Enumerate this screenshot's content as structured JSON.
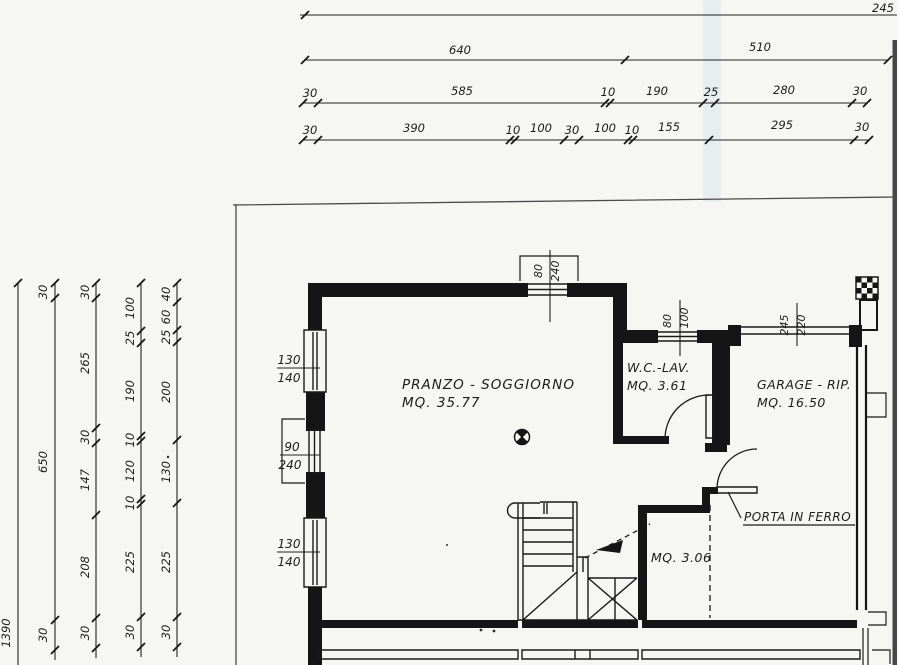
{
  "colors": {
    "ink": "#1c1c1c",
    "paper": "#f6f6f3",
    "scan_edge": "#474747",
    "artifact_band": "#d7e2ea"
  },
  "rooms": {
    "pranzo": {
      "name": "PRANZO - SOGGIORNO",
      "area": "MQ. 35.77"
    },
    "wc": {
      "name": "W.C.-LAV.",
      "area": "MQ. 3.61"
    },
    "garage": {
      "name": "GARAGE - RIP.",
      "area": "MQ. 16.50"
    },
    "hall": {
      "area": "MQ. 3.06"
    },
    "door_note": "PORTA IN FERRO"
  },
  "openings": {
    "win1": {
      "w": "130",
      "h": "140"
    },
    "door_left": {
      "w": "90",
      "h": "240"
    },
    "win2": {
      "w": "130",
      "h": "140"
    },
    "entrance": {
      "w": "80",
      "h": "240"
    },
    "wc_window": {
      "w": "80",
      "h": "100"
    },
    "garage_door": {
      "w": "245",
      "h": "220"
    }
  },
  "dims": {
    "top": {
      "row1": [
        "245"
      ],
      "row2": [
        "640",
        "510"
      ],
      "row3": [
        "30",
        "585",
        "10",
        "190",
        "25",
        "280",
        "30"
      ],
      "row4": [
        "30",
        "390",
        "10",
        "100",
        "30",
        "100",
        "10",
        "155",
        "295",
        "30"
      ]
    },
    "left": {
      "c1": [
        "1390"
      ],
      "c2": [
        "30",
        "650",
        "30"
      ],
      "c3": [
        "30",
        "265",
        "30",
        "147",
        "208",
        "30"
      ],
      "c4": [
        "100",
        "25",
        "190",
        "10",
        "120",
        "10",
        "225",
        "30"
      ],
      "c5": [
        "40",
        "60",
        "25",
        "200",
        "130",
        "225",
        "30"
      ]
    }
  }
}
